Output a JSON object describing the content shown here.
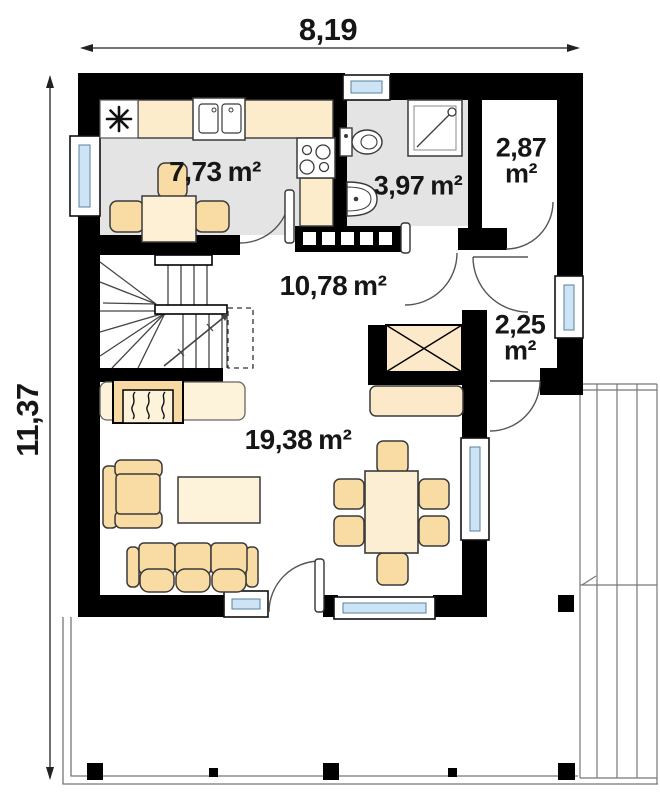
{
  "plan": {
    "type": "floor-plan-ground-floor",
    "dimensions": {
      "width": "8,19",
      "height": "11,37"
    },
    "rooms": {
      "kitchen": {
        "area": "7,73",
        "unit": "m²"
      },
      "bathroom": {
        "area": "3,97",
        "unit": "m²"
      },
      "pantry": {
        "area": "2,87",
        "unit": "m²"
      },
      "hall": {
        "area": "10,78",
        "unit": "m²"
      },
      "vestibule": {
        "area": "2,25",
        "unit": "m²"
      },
      "living_room": {
        "area": "19,38",
        "unit": "m²"
      }
    },
    "icons": [
      {
        "name": "freezer-snowflake-icon",
        "glyph": "✳"
      }
    ],
    "colors": {
      "wall": "#000000",
      "floor_gray": "#e4e4e4",
      "counter": "#fceccb",
      "furniture": "#f9dba4",
      "table": "#fdf2da",
      "glass": "#cde4f6"
    }
  }
}
